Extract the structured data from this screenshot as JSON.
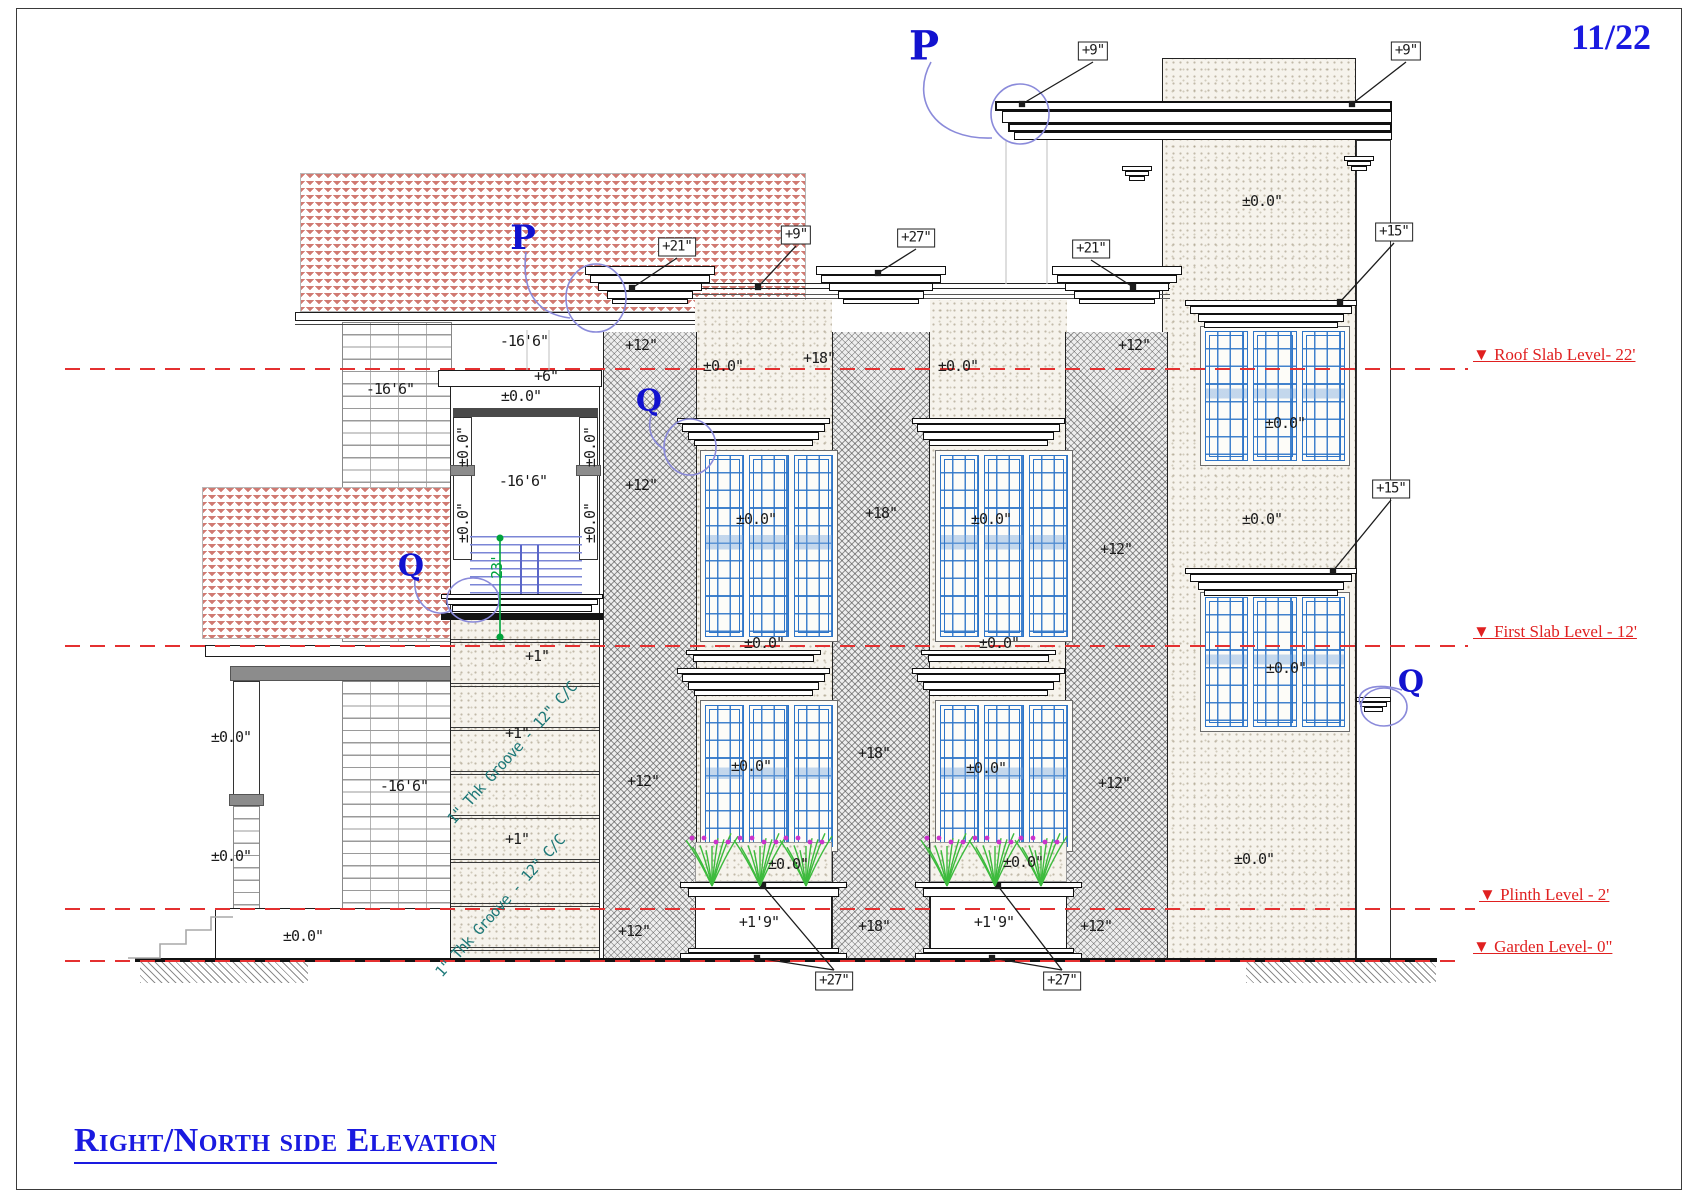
{
  "page": {
    "sheet_number": "11/22",
    "title": "Right/North side Elevation"
  },
  "colors": {
    "level_red": "#e02020",
    "marker_blue": "#1212cf",
    "window_blue": "#2e75c8",
    "groove_teal": "#1d7878",
    "dim_green": "#00a33c",
    "title_blue": "#1a1ae0",
    "leader_blue": "#8a8ada"
  },
  "levels": [
    {
      "name": "roof-slab-level",
      "label": "▼ Roof Slab Level- 22'",
      "y": 368,
      "label_x": 1473,
      "line_w": 1403
    },
    {
      "name": "first-slab-level",
      "label": "▼ First Slab Level - 12'",
      "y": 645,
      "label_x": 1473,
      "line_w": 1403
    },
    {
      "name": "plinth-level",
      "label": "▼ Plinth Level - 2'",
      "y": 908,
      "label_x": 1479,
      "line_w": 1410
    },
    {
      "name": "garden-level",
      "label": "▼ Garden Level- 0\"",
      "y": 960,
      "label_x": 1473,
      "line_w": 1392
    }
  ],
  "boxed_labels": [
    {
      "text": "+9\"",
      "x": 1093,
      "y": 51,
      "targets": [
        [
          1022,
          104
        ]
      ]
    },
    {
      "text": "+9\"",
      "x": 1406,
      "y": 51,
      "targets": [
        [
          1352,
          104
        ]
      ]
    },
    {
      "text": "+21\"",
      "x": 677,
      "y": 247,
      "targets": [
        [
          632,
          288
        ]
      ]
    },
    {
      "text": "+9\"",
      "x": 796,
      "y": 235,
      "targets": [
        [
          758,
          287
        ]
      ]
    },
    {
      "text": "+27\"",
      "x": 916,
      "y": 238,
      "targets": [
        [
          878,
          273
        ]
      ]
    },
    {
      "text": "+21\"",
      "x": 1091,
      "y": 249,
      "targets": [
        [
          1133,
          287
        ]
      ]
    },
    {
      "text": "+15\"",
      "x": 1394,
      "y": 232,
      "targets": [
        [
          1340,
          302
        ]
      ]
    },
    {
      "text": "+15\"",
      "x": 1391,
      "y": 489,
      "targets": [
        [
          1333,
          571
        ]
      ]
    },
    {
      "text": "+27\"",
      "x": 834,
      "y": 981,
      "targets": [
        [
          763,
          886
        ],
        [
          757,
          958
        ]
      ]
    },
    {
      "text": "+27\"",
      "x": 1062,
      "y": 981,
      "targets": [
        [
          998,
          886
        ],
        [
          992,
          958
        ]
      ]
    }
  ],
  "dim_labels": [
    {
      "text": "-16'6\"",
      "x": 524,
      "y": 341
    },
    {
      "text": "+6\"",
      "x": 546,
      "y": 376
    },
    {
      "text": "±0.0\"",
      "x": 521,
      "y": 396
    },
    {
      "text": "-16'6\"",
      "x": 390,
      "y": 389
    },
    {
      "text": "-16'6\"",
      "x": 523,
      "y": 481
    },
    {
      "text": "-16'6\"",
      "x": 404,
      "y": 786
    },
    {
      "text": "±0.0\"",
      "x": 231,
      "y": 737
    },
    {
      "text": "±0.0\"",
      "x": 231,
      "y": 856
    },
    {
      "text": "±0.0\"",
      "x": 303,
      "y": 936
    },
    {
      "text": "±0.0\"",
      "x": 463,
      "y": 447,
      "rot": 90
    },
    {
      "text": "±0.0\"",
      "x": 590,
      "y": 447,
      "rot": 90
    },
    {
      "text": "±0.0\"",
      "x": 463,
      "y": 523,
      "rot": 90
    },
    {
      "text": "±0.0\"",
      "x": 590,
      "y": 523,
      "rot": 90
    },
    {
      "text": "23'",
      "x": 497,
      "y": 567,
      "rot": 90,
      "color": "green"
    },
    {
      "text": "+1\"",
      "x": 537,
      "y": 656
    },
    {
      "text": "+1\"",
      "x": 517,
      "y": 733
    },
    {
      "text": "+1\"",
      "x": 517,
      "y": 839
    },
    {
      "text": "1\" Thk Groove - 12\" C/C",
      "x": 512,
      "y": 753,
      "diag": true,
      "color": "teal"
    },
    {
      "text": "1\" Thk Groove - 12\" C/C",
      "x": 500,
      "y": 906,
      "diag": true,
      "color": "teal"
    },
    {
      "text": "+12\"",
      "x": 641,
      "y": 345
    },
    {
      "text": "+12\"",
      "x": 641,
      "y": 485
    },
    {
      "text": "+12\"",
      "x": 643,
      "y": 781
    },
    {
      "text": "+12\"",
      "x": 634,
      "y": 931
    },
    {
      "text": "+18\"",
      "x": 819,
      "y": 358
    },
    {
      "text": "+18\"",
      "x": 881,
      "y": 513
    },
    {
      "text": "+18\"",
      "x": 874,
      "y": 753
    },
    {
      "text": "+18\"",
      "x": 874,
      "y": 926
    },
    {
      "text": "+12\"",
      "x": 1134,
      "y": 345
    },
    {
      "text": "+12\"",
      "x": 1116,
      "y": 549
    },
    {
      "text": "+12\"",
      "x": 1114,
      "y": 783
    },
    {
      "text": "+12\"",
      "x": 1096,
      "y": 926
    },
    {
      "text": "±0.0\"",
      "x": 723,
      "y": 366
    },
    {
      "text": "±0.0\"",
      "x": 756,
      "y": 519
    },
    {
      "text": "±0.0\"",
      "x": 764,
      "y": 643
    },
    {
      "text": "±0.0\"",
      "x": 751,
      "y": 766
    },
    {
      "text": "±0.0\"",
      "x": 788,
      "y": 864
    },
    {
      "text": "+1'9\"",
      "x": 759,
      "y": 922
    },
    {
      "text": "±0.0\"",
      "x": 958,
      "y": 366
    },
    {
      "text": "±0.0\"",
      "x": 991,
      "y": 519
    },
    {
      "text": "±0.0\"",
      "x": 999,
      "y": 643
    },
    {
      "text": "±0.0\"",
      "x": 986,
      "y": 768
    },
    {
      "text": "±0.0\"",
      "x": 1023,
      "y": 862
    },
    {
      "text": "+1'9\"",
      "x": 994,
      "y": 922
    },
    {
      "text": "±0.0\"",
      "x": 1262,
      "y": 201
    },
    {
      "text": "±0.0\"",
      "x": 1285,
      "y": 423
    },
    {
      "text": "±0.0\"",
      "x": 1262,
      "y": 519
    },
    {
      "text": "±0.0\"",
      "x": 1286,
      "y": 668
    },
    {
      "text": "±0.0\"",
      "x": 1254,
      "y": 859
    }
  ],
  "markers": [
    {
      "letter": "P",
      "x": 924,
      "y": 46,
      "size": 40
    },
    {
      "letter": "P",
      "x": 523,
      "y": 238,
      "size": 34
    },
    {
      "letter": "Q",
      "x": 411,
      "y": 566,
      "size": 30
    },
    {
      "letter": "Q",
      "x": 649,
      "y": 401,
      "size": 30
    },
    {
      "letter": "Q",
      "x": 1411,
      "y": 682,
      "size": 30
    }
  ]
}
